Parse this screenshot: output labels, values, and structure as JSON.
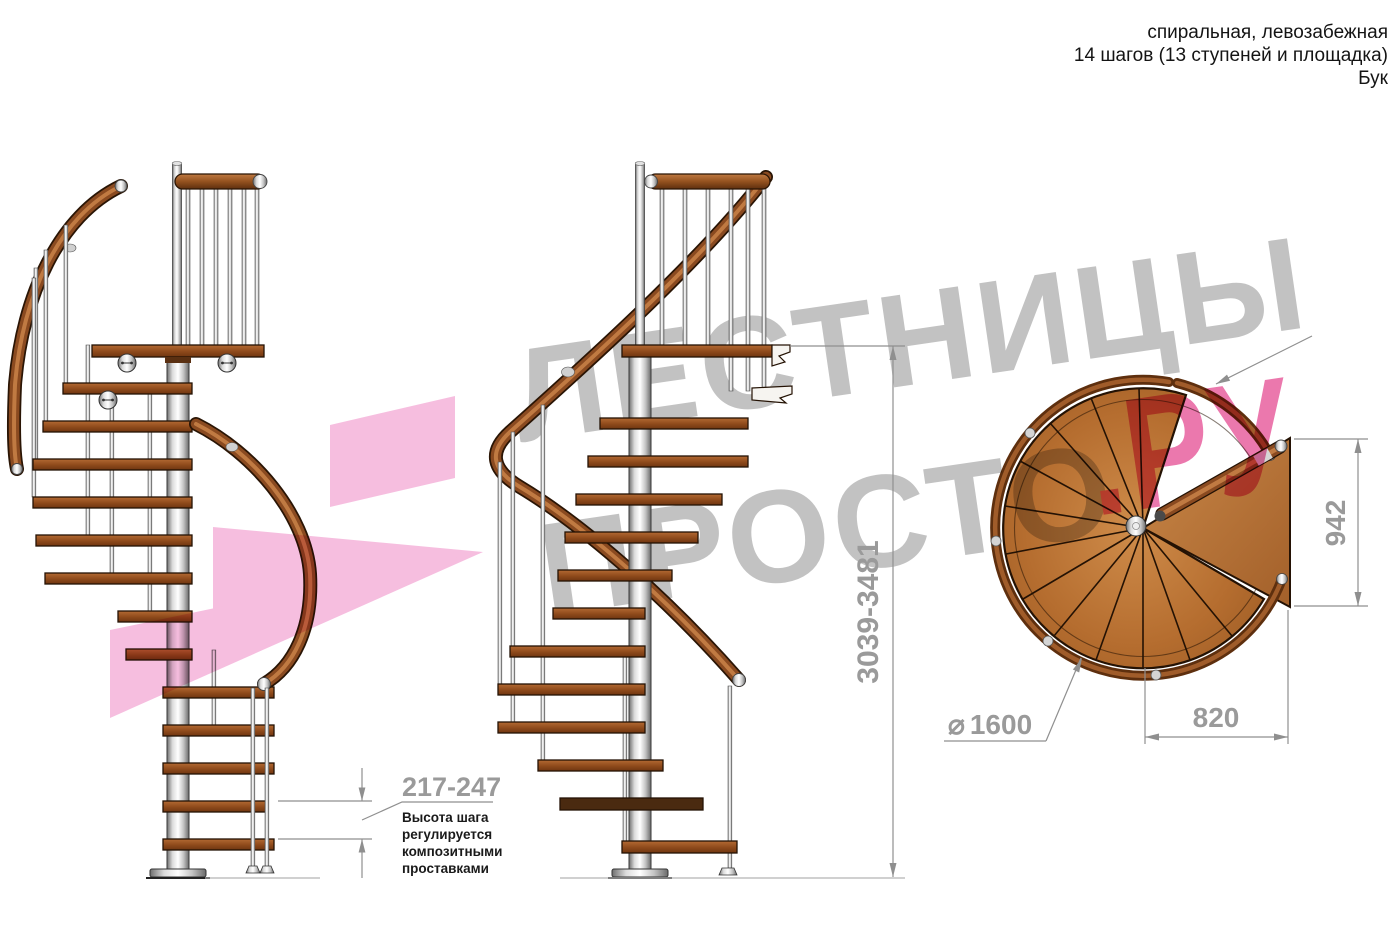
{
  "header": {
    "line1": "спиральная, левозабежная",
    "line2": "14 шагов (13 ступеней и площадка)",
    "line3": "Бук"
  },
  "watermark": {
    "brand_line1": "ЛЕСТНИЦЫ",
    "brand_line2": "ПРОСТО",
    "brand_suffix": ".РУ",
    "gray_color": "#bdbdbd",
    "pink_color": "#ea6ca6",
    "arrow_pink_color": "#f5b3da"
  },
  "dimensions": {
    "total_height": "3039-3481",
    "step_height": "217-247",
    "landing_width": "942",
    "landing_depth": "820",
    "diameter_symbol": "⌀",
    "diameter_value": "1600"
  },
  "note": {
    "line1": "Высота шага",
    "line2": "регулируется",
    "line3": "композитными",
    "line4": "проставками"
  },
  "colors": {
    "wood": "#9c5a26",
    "handrail": "#8a4a20",
    "metal": "#cccccc",
    "dimension_gray": "#9a9a9a",
    "text_black": "#141414"
  }
}
